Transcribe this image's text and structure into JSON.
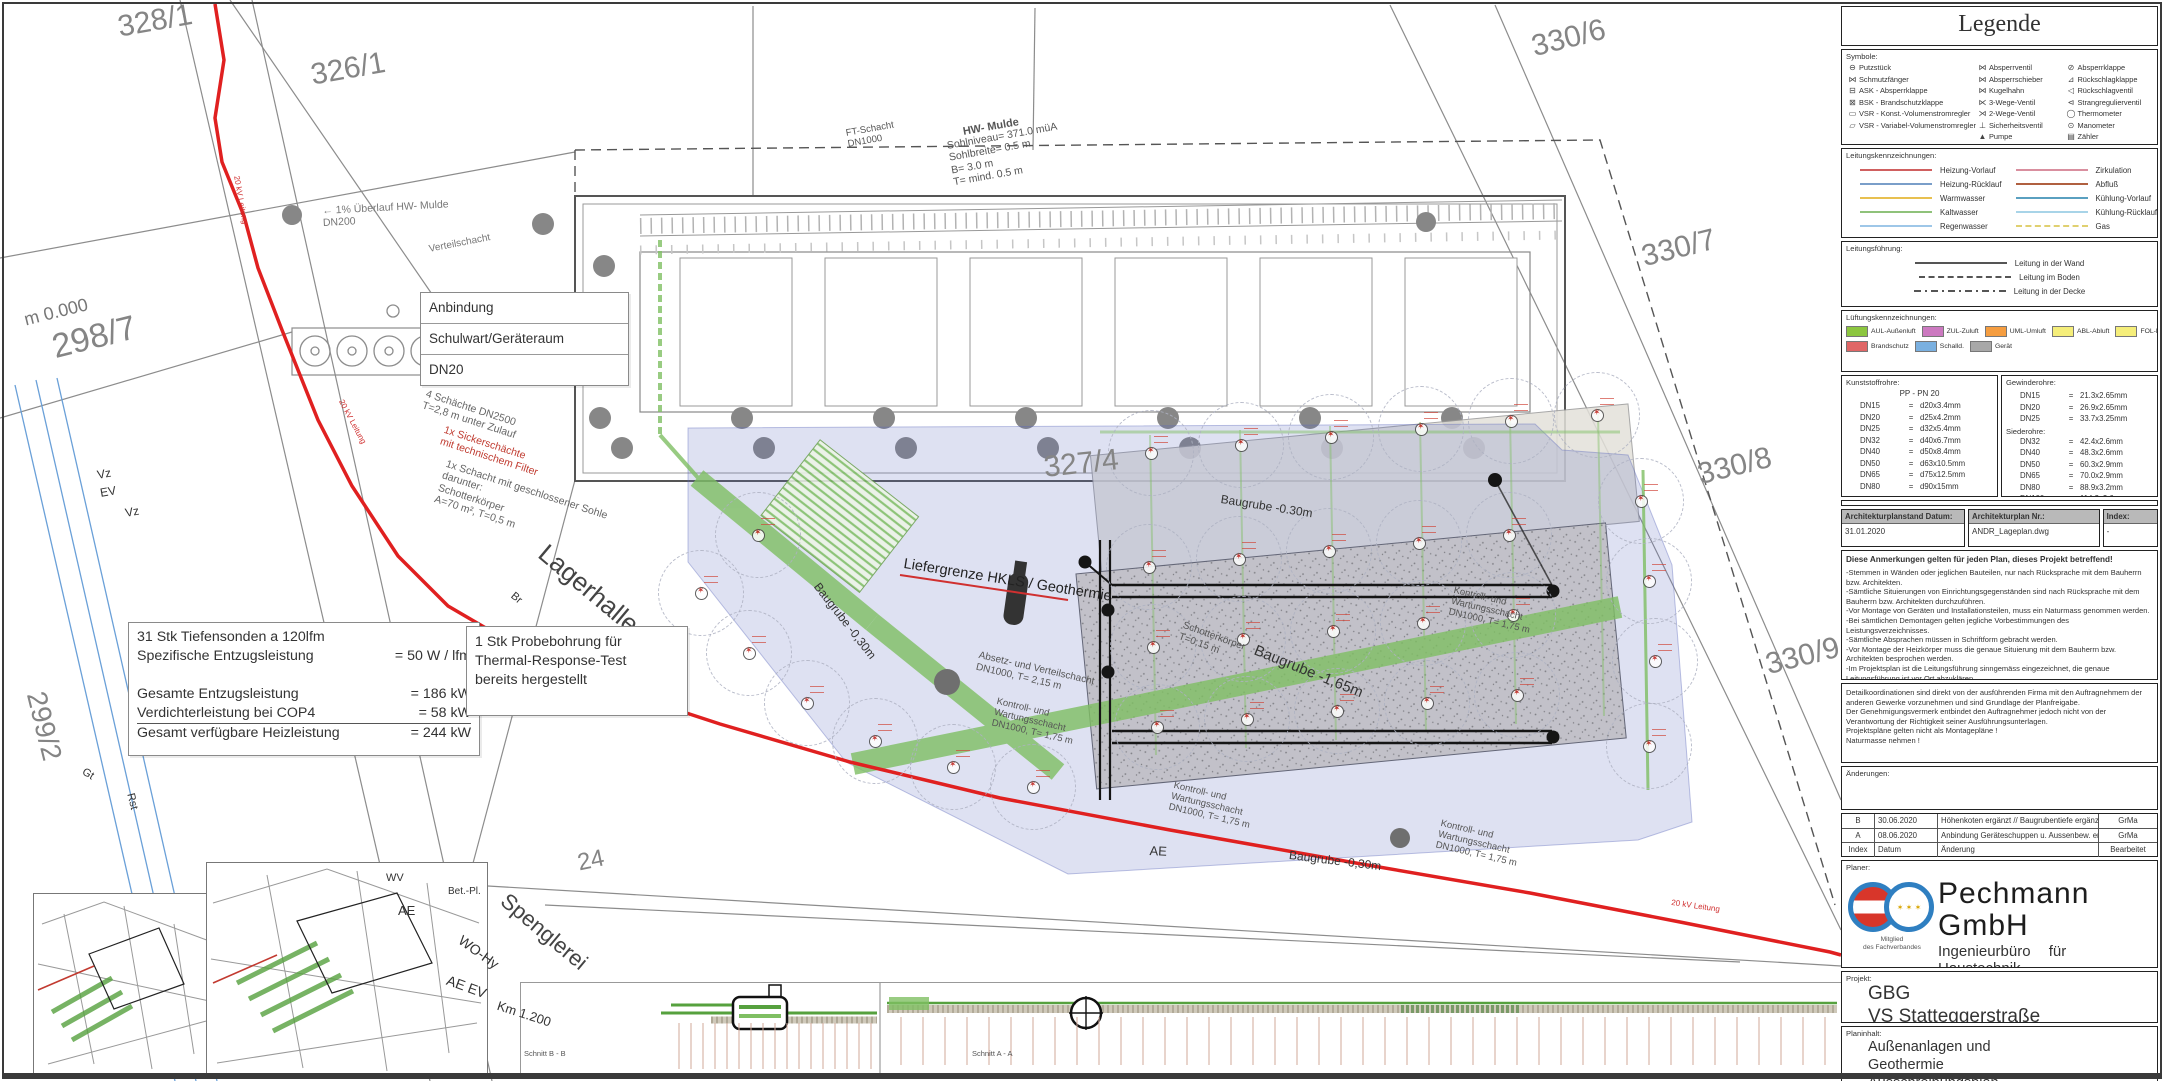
{
  "legend": {
    "title": "Legende",
    "symbols_label": "Symbole:",
    "symbol_cols": [
      [
        {
          "g": "⊖",
          "t": "Putzstück"
        },
        {
          "g": "⋈",
          "t": "Schmutzfänger"
        },
        {
          "g": "⊟",
          "t": "ASK - Absperrklappe"
        },
        {
          "g": "⊠",
          "t": "BSK - Brandschutzklappe"
        },
        {
          "g": "▭",
          "t": "VSR - Konst.-Volumenstromregler"
        },
        {
          "g": "▱",
          "t": "VSR - Variabel-Volumenstromregler"
        }
      ],
      [
        {
          "g": "⋈",
          "t": "Absperrventil"
        },
        {
          "g": "⋈",
          "t": "Absperrschieber"
        },
        {
          "g": "⋈",
          "t": "Kugelhahn"
        },
        {
          "g": "⋉",
          "t": "3-Wege-Ventil"
        },
        {
          "g": "⋊",
          "t": "2-Wege-Ventil"
        },
        {
          "g": "⊥",
          "t": "Sicherheitsventil"
        },
        {
          "g": "▲",
          "t": "Pumpe"
        }
      ],
      [
        {
          "g": "⊘",
          "t": "Absperrklappe"
        },
        {
          "g": "⊿",
          "t": "Rückschlagklappe"
        },
        {
          "g": "◁",
          "t": "Rückschlagventil"
        },
        {
          "g": "⊲",
          "t": "Strangregulierventil"
        },
        {
          "g": "◯",
          "t": "Thermometer"
        },
        {
          "g": "⊙",
          "t": "Manometer"
        },
        {
          "g": "▤",
          "t": "Zähler"
        }
      ]
    ],
    "lines_label": "Leitungskennzeichnungen:",
    "line_cols": [
      [
        {
          "c": "#d06060",
          "t": "Heizung-Vorlauf"
        },
        {
          "c": "#7a9ec9",
          "t": "Heizung-Rücklauf"
        },
        {
          "c": "#e8c050",
          "t": "Warmwasser"
        },
        {
          "c": "#8fc27a",
          "t": "Kaltwasser"
        },
        {
          "c": "#9ec7e8",
          "t": "Regenwasser"
        }
      ],
      [
        {
          "c": "#d98f9f",
          "t": "Zirkulation"
        },
        {
          "c": "#b06040",
          "t": "Abfluß"
        },
        {
          "c": "#5aa0c0",
          "t": "Kühlung-Vorlauf"
        },
        {
          "c": "#a8d4e8",
          "t": "Kühlung-Rücklauf"
        },
        {
          "c": "#e0d070",
          "t": "Gas",
          "dash": true
        }
      ]
    ],
    "routing_label": "Leitungsführung:",
    "routing": [
      {
        "style": "solid",
        "t": "Leitung in der Wand"
      },
      {
        "style": "dashed",
        "t": "Leitung im Boden"
      },
      {
        "style": "dashdot",
        "t": "Leitung in der Decke"
      }
    ],
    "vent_label": "Lüftungskennzeichnungen:",
    "vent_row1": [
      {
        "c": "#8cc63f",
        "t": "AUL-Außenluft"
      },
      {
        "c": "#cc79c0",
        "t": "ZUL-Zuluft"
      },
      {
        "c": "#f59d40",
        "t": "UML-Umluft"
      },
      {
        "c": "#f5ee7a",
        "t": "ABL-Abluft"
      },
      {
        "c": "#f5ee7a",
        "t": "FOL-Fortluft"
      }
    ],
    "vent_row2": [
      {
        "c": "#e06666",
        "t": "Brandschutz"
      },
      {
        "c": "#7ab0e0",
        "t": "Schalld.",
        "striped": true
      },
      {
        "c": "#a8a8a8",
        "t": "Gerät"
      }
    ],
    "plastic_label": "Kunststoffrohre:",
    "plastic_header": "PP  -  PN 20",
    "plastic_rows": [
      [
        "DN15",
        "d20x3.4mm"
      ],
      [
        "DN20",
        "d25x4.2mm"
      ],
      [
        "DN25",
        "d32x5.4mm"
      ],
      [
        "DN32",
        "d40x6.7mm"
      ],
      [
        "DN40",
        "d50x8.4mm"
      ],
      [
        "DN50",
        "d63x10.5mm"
      ],
      [
        "DN65",
        "d75x12.5mm"
      ],
      [
        "DN80",
        "d90x15mm"
      ]
    ],
    "threaded_label": "Gewinderohre:",
    "threaded_rows": [
      [
        "DN15",
        "21.3x2.65mm"
      ],
      [
        "DN20",
        "26.9x2.65mm"
      ],
      [
        "DN25",
        "33.7x3.25mm"
      ]
    ],
    "boiler_label": "Siederohre:",
    "boiler_rows": [
      [
        "DN32",
        "42.4x2.6mm"
      ],
      [
        "DN40",
        "48.3x2.6mm"
      ],
      [
        "DN50",
        "60.3x2.9mm"
      ],
      [
        "DN65",
        "70.0x2.9mm"
      ],
      [
        "DN80",
        "88.9x3.2mm"
      ],
      [
        "DN100",
        "114.3x3.6mm"
      ]
    ]
  },
  "plan_status": {
    "col1_label": "Architekturplanstand Datum:",
    "col1": "31.01.2020",
    "col2_label": "Architekturplan Nr.:",
    "col2": "ANDR_Lageplan.dwg",
    "col3_label": "Index:",
    "col3": "-"
  },
  "notes": {
    "title": "Diese Anmerkungen gelten für jeden Plan, dieses Projekt betreffend!",
    "items": [
      "-Stemmen in Wänden oder jeglichen Bauteilen, nur nach Rücksprache mit dem Bauherrn bzw. Architekten.",
      "-Sämtliche Situierungen von Einrichtungsgegenständen sind nach Rücksprache mit dem Bauherrn bzw. Architekten durchzuführen.",
      "-Vor Montage von Geräten und Installationsteilen, muss ein Naturmass genommen werden.",
      "-Bei sämtlichen Demontagen gelten jegliche Vorbestimmungen des Leistungsverzeichnisses.",
      "-Sämtliche Absprachen müssen in Schriftform gebracht werden.",
      "-Vor Montage der Heizkörper muss die genaue Situierung mit dem Bauherrn bzw. Architekten besprochen werden.",
      "-Im Projektsplan ist die Leitungsführung sinngemäss eingezeichnet, die genaue Leitungsführung ist vor Ort abzuklären.",
      "-Nach Auftragsvergabe ist ein Montageplan in 3-facher Ausfertigung zu zeichnen und dem Technischen Büro zur Freigabe vorzulegen."
    ]
  },
  "notes2": {
    "items": [
      "Detailkoordinationen sind direkt von der ausführenden Firma mit den Auftragnehmern der anderen Gewerke vorzunehmen und sind Grundlage der Planfreigabe.",
      "Der Genehmigungsvermerk entbindet den Auftragnehmer jedoch nicht von der Verantwortung der Richtigkeit seiner Ausführungsunterlagen.",
      "Projektspläne gelten nicht als Montagepläne !",
      "Naturmasse nehmen !"
    ]
  },
  "changes_label": "Änderungen:",
  "revisions": {
    "rows": [
      [
        "B",
        "30.06.2020",
        "Höhenkoten ergänzt // Baugrubentiefe ergänzt",
        "GrMa"
      ],
      [
        "A",
        "08.06.2020",
        "Anbindung Geräteschuppen u. Aussenbew. ergänzt",
        "GrMa"
      ]
    ],
    "header": [
      "Index",
      "Datum",
      "Änderung",
      "Bearbeitet"
    ]
  },
  "planner": {
    "label": "Planer:",
    "member": "Mitglied\ndes Fachverbandes",
    "stars": "✶ ✶ ✶",
    "company": "Pechmann GmbH",
    "tagline": "Ingenieurbüro für Haustechnik",
    "address1": "Grazer Straße 48f, A - 8062 Kumberg",
    "address2": "Tel.: 03132/5485 Fax.: 03132/5485-16",
    "address3": "e-mail: office@tb-pechmann.at"
  },
  "project": {
    "label": "Projekt:",
    "line1": "GBG",
    "line2": "VS Statteggerstraße"
  },
  "content": {
    "label": "Planinhalt:",
    "lines": [
      "Außenanlagen und",
      "Geothermie",
      "Ausschreibungsplan"
    ]
  },
  "meta": {
    "date_label": "Datum",
    "date": "14.04.2020",
    "drawn_label": "Gezeichnet",
    "drawn": "GrMa",
    "scale_label": "Maßstab:",
    "scale": "1:200",
    "plan_no_label": "Plan Nr.:",
    "plan_no": "1944"
  },
  "anbindung": [
    "Anbindung",
    "Schulwart/Geräteraum",
    "DN20"
  ],
  "info_box1": {
    "rows": [
      [
        "31 Stk Tiefensonden a 120lfm",
        ""
      ],
      [
        "Spezifische Entzugsleistung",
        "=   50 W / lfm"
      ],
      [
        "",
        ""
      ],
      [
        "Gesamte Entzugsleistung",
        "= 186 kW"
      ],
      [
        "Verdichterleistung bei COP4",
        "=   58 kW"
      ],
      [
        "Gesamt verfügbare Heizleistung",
        "= 244 kW"
      ]
    ]
  },
  "info_box2": {
    "text": "1 Stk Probebohrung für\nThermal-Response-Test\nbereits hergestellt"
  },
  "annotations": [
    {
      "id": "parcel-328-1",
      "text": "328/1"
    },
    {
      "id": "parcel-326-1",
      "text": "326/1"
    },
    {
      "id": "parcel-330-6",
      "text": "330/6"
    },
    {
      "id": "parcel-330-7",
      "text": "330/7"
    },
    {
      "id": "parcel-330-8",
      "text": "330/8"
    },
    {
      "id": "parcel-330-9",
      "text": "330/9"
    },
    {
      "id": "parcel-327-4",
      "text": "327/4"
    },
    {
      "id": "parcel-298-7",
      "text": "298/7"
    },
    {
      "id": "parcel-299-2",
      "text": "299/2"
    },
    {
      "id": "parcel-24",
      "text": "24"
    },
    {
      "id": "height-datum",
      "text": "m 0.000"
    },
    {
      "id": "lagerhalle",
      "text": "Lagerhalle"
    },
    {
      "id": "spenglerei",
      "text": "Spenglerei"
    },
    {
      "id": "hw-mulde-title",
      "text": "HW- Mulde"
    },
    {
      "id": "hw-mulde-specs",
      "text": "Sohlniveau= 371.0 müA\nSohlbreite= 0.5 m\nB= 3.0 m\nT= mind. 0.5 m"
    },
    {
      "id": "ft-schacht",
      "text": "FT-Schacht\nDN1000"
    },
    {
      "id": "ueberlauf",
      "text": "← 1% Überlauf HW- Mulde\nDN200"
    },
    {
      "id": "verteilschacht",
      "text": "Verteilschacht"
    },
    {
      "id": "schaechte-1",
      "text": "4 Schächte DN2500\nT=2,8 m unter Zulauf"
    },
    {
      "id": "schaechte-2",
      "text": "1x Sickerschächte\nmit technischem Filter"
    },
    {
      "id": "schaechte-3",
      "text": "1x Schacht mit geschlossener Sohle\ndarunter:\nSchotterkörper\nA=70 m², T=0,5 m"
    },
    {
      "id": "liefergrenze",
      "text": "Liefergrenze HKLS / Geothermie"
    },
    {
      "id": "baugrube-030-west",
      "text": "Baugrube -0,30m"
    },
    {
      "id": "baugrube-030-nord",
      "text": "Baugrube -0.30m"
    },
    {
      "id": "baugrube-030-sued",
      "text": "Baugrube -0,30m"
    },
    {
      "id": "baugrube-165",
      "text": "Baugrube -1,65m"
    },
    {
      "id": "schotterkoerper",
      "text": "Schotterkörper\nT=0,15 m"
    },
    {
      "id": "absetzschacht",
      "text": "Absetz- und Verteilschacht\nDN1000, T= 2,15 m"
    },
    {
      "id": "kontroll-1",
      "text": "Kontroll- und\nWartungsschacht\nDN1000, T= 1,75 m"
    },
    {
      "id": "kontroll-2",
      "text": "Kontroll- und\nWartungsschacht\nDN1000, T= 1,75 m"
    },
    {
      "id": "kontroll-3",
      "text": "Kontroll- und\nWartungsschacht\nDN1000, T= 1,75 m"
    },
    {
      "id": "kontroll-4",
      "text": "Kontroll- und\nWartungsschacht\nDN1000, T= 1,75 m"
    },
    {
      "id": "kv-1",
      "text": "20 kV Leitung"
    },
    {
      "id": "kv-2",
      "text": "20 kV Leitung"
    },
    {
      "id": "kv-3",
      "text": "20 kV Leitung"
    },
    {
      "id": "ae-1",
      "text": "AE"
    },
    {
      "id": "ae-2",
      "text": "AE"
    },
    {
      "id": "wv",
      "text": "WV"
    },
    {
      "id": "vz-1",
      "text": "Vz"
    },
    {
      "id": "ev-1",
      "text": "EV"
    },
    {
      "id": "vz-2",
      "text": "Vz"
    },
    {
      "id": "rst",
      "text": "Rst"
    },
    {
      "id": "gt",
      "text": "Gt"
    },
    {
      "id": "br",
      "text": "Br"
    },
    {
      "id": "wo-hy",
      "text": "WO-Hy"
    },
    {
      "id": "ae-ev",
      "text": "AE EV"
    },
    {
      "id": "km",
      "text": "Km 1.200"
    },
    {
      "id": "bet-pl",
      "text": "Bet.-Pl."
    },
    {
      "id": "schnitt-a",
      "text": "Schnitt A - A"
    },
    {
      "id": "schnitt-b",
      "text": "Schnitt B - B"
    }
  ]
}
